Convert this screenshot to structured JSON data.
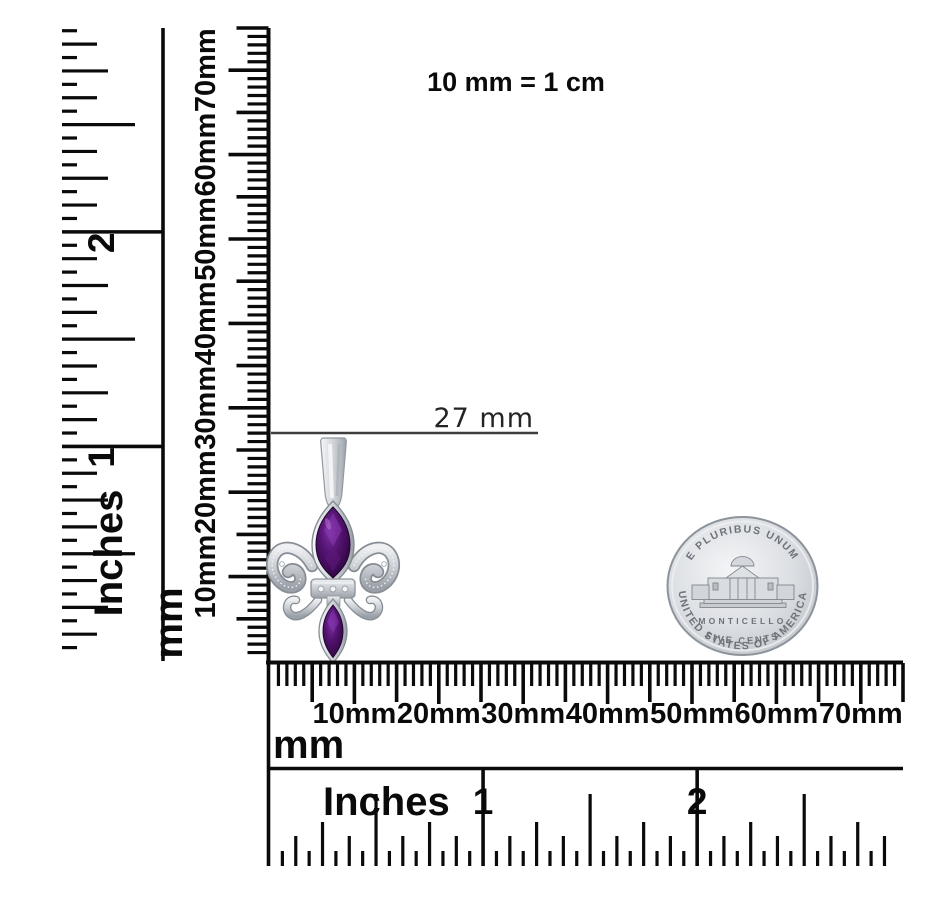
{
  "title_note": "10 mm = 1 cm",
  "annotation": {
    "label": "27 mm"
  },
  "rulers": {
    "vertical_inches": {
      "unit_label": "Inches",
      "tick_labels": [
        "1",
        "2"
      ]
    },
    "vertical_mm": {
      "unit_label": "mm",
      "tick_labels": [
        "10mm",
        "20mm",
        "30mm",
        "40mm",
        "50mm",
        "60mm",
        "70mm"
      ]
    },
    "horizontal_mm": {
      "unit_label": "mm",
      "tick_labels": [
        "10mm",
        "20mm",
        "30mm",
        "40mm",
        "50mm",
        "60mm",
        "70mm"
      ]
    },
    "horizontal_inches": {
      "unit_label": "Inches",
      "tick_labels": [
        "1",
        "2"
      ]
    }
  },
  "coin": {
    "top_text": "E PLURIBUS UNUM",
    "building_label": "MONTICELLO",
    "denomination": "FIVE CENTS",
    "bottom_text": "UNITED STATES OF AMERICA"
  },
  "pendant": {
    "description": "Silver fleur-de-lis pendant with two purple marquise gemstones",
    "stone_color": "#4a1163",
    "metal_color": "#ccd0d5"
  },
  "colors": {
    "ink": "#0a0a0a",
    "annotation_line": "#3d3d3d",
    "background": "#ffffff"
  }
}
